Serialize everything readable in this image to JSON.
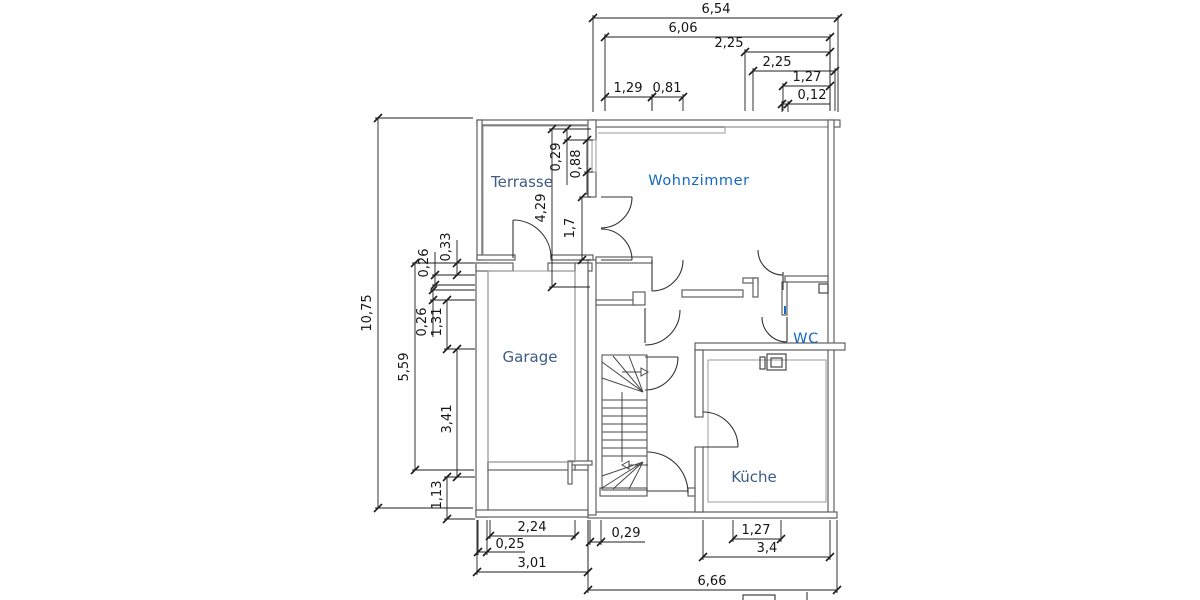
{
  "drawing": {
    "type": "floor-plan",
    "units": "m"
  },
  "colors": {
    "background": "#ffffff",
    "wall": "#606060",
    "lining": "#9a9a9a",
    "dimension": "#1c1c1c",
    "room_label": "#3e5c85",
    "room_label_accent": "#1668c4"
  },
  "rooms": [
    {
      "label": "Terrasse",
      "style": "primary"
    },
    {
      "label": "Wohnzimmer",
      "style": "accent"
    },
    {
      "label": "Garage",
      "style": "primary"
    },
    {
      "label": "WC",
      "style": "accent"
    },
    {
      "label": "Küche",
      "style": "primary"
    }
  ],
  "dimensions": {
    "top": [
      "6,54",
      "6,06",
      "2,25",
      "2,25",
      "1,27",
      "0,12",
      "1,29",
      "0,81"
    ],
    "left": [
      "10,75",
      "0,33",
      "0,26",
      "5,59",
      "0,26",
      "1,31",
      "3,41",
      "1,13"
    ],
    "inner": [
      "4,29",
      "0,29",
      "0,88",
      "1,7"
    ],
    "bottom": [
      "2,24",
      "0,25",
      "3,01",
      "0,29",
      "1,27",
      "3,4",
      "6,66"
    ]
  }
}
